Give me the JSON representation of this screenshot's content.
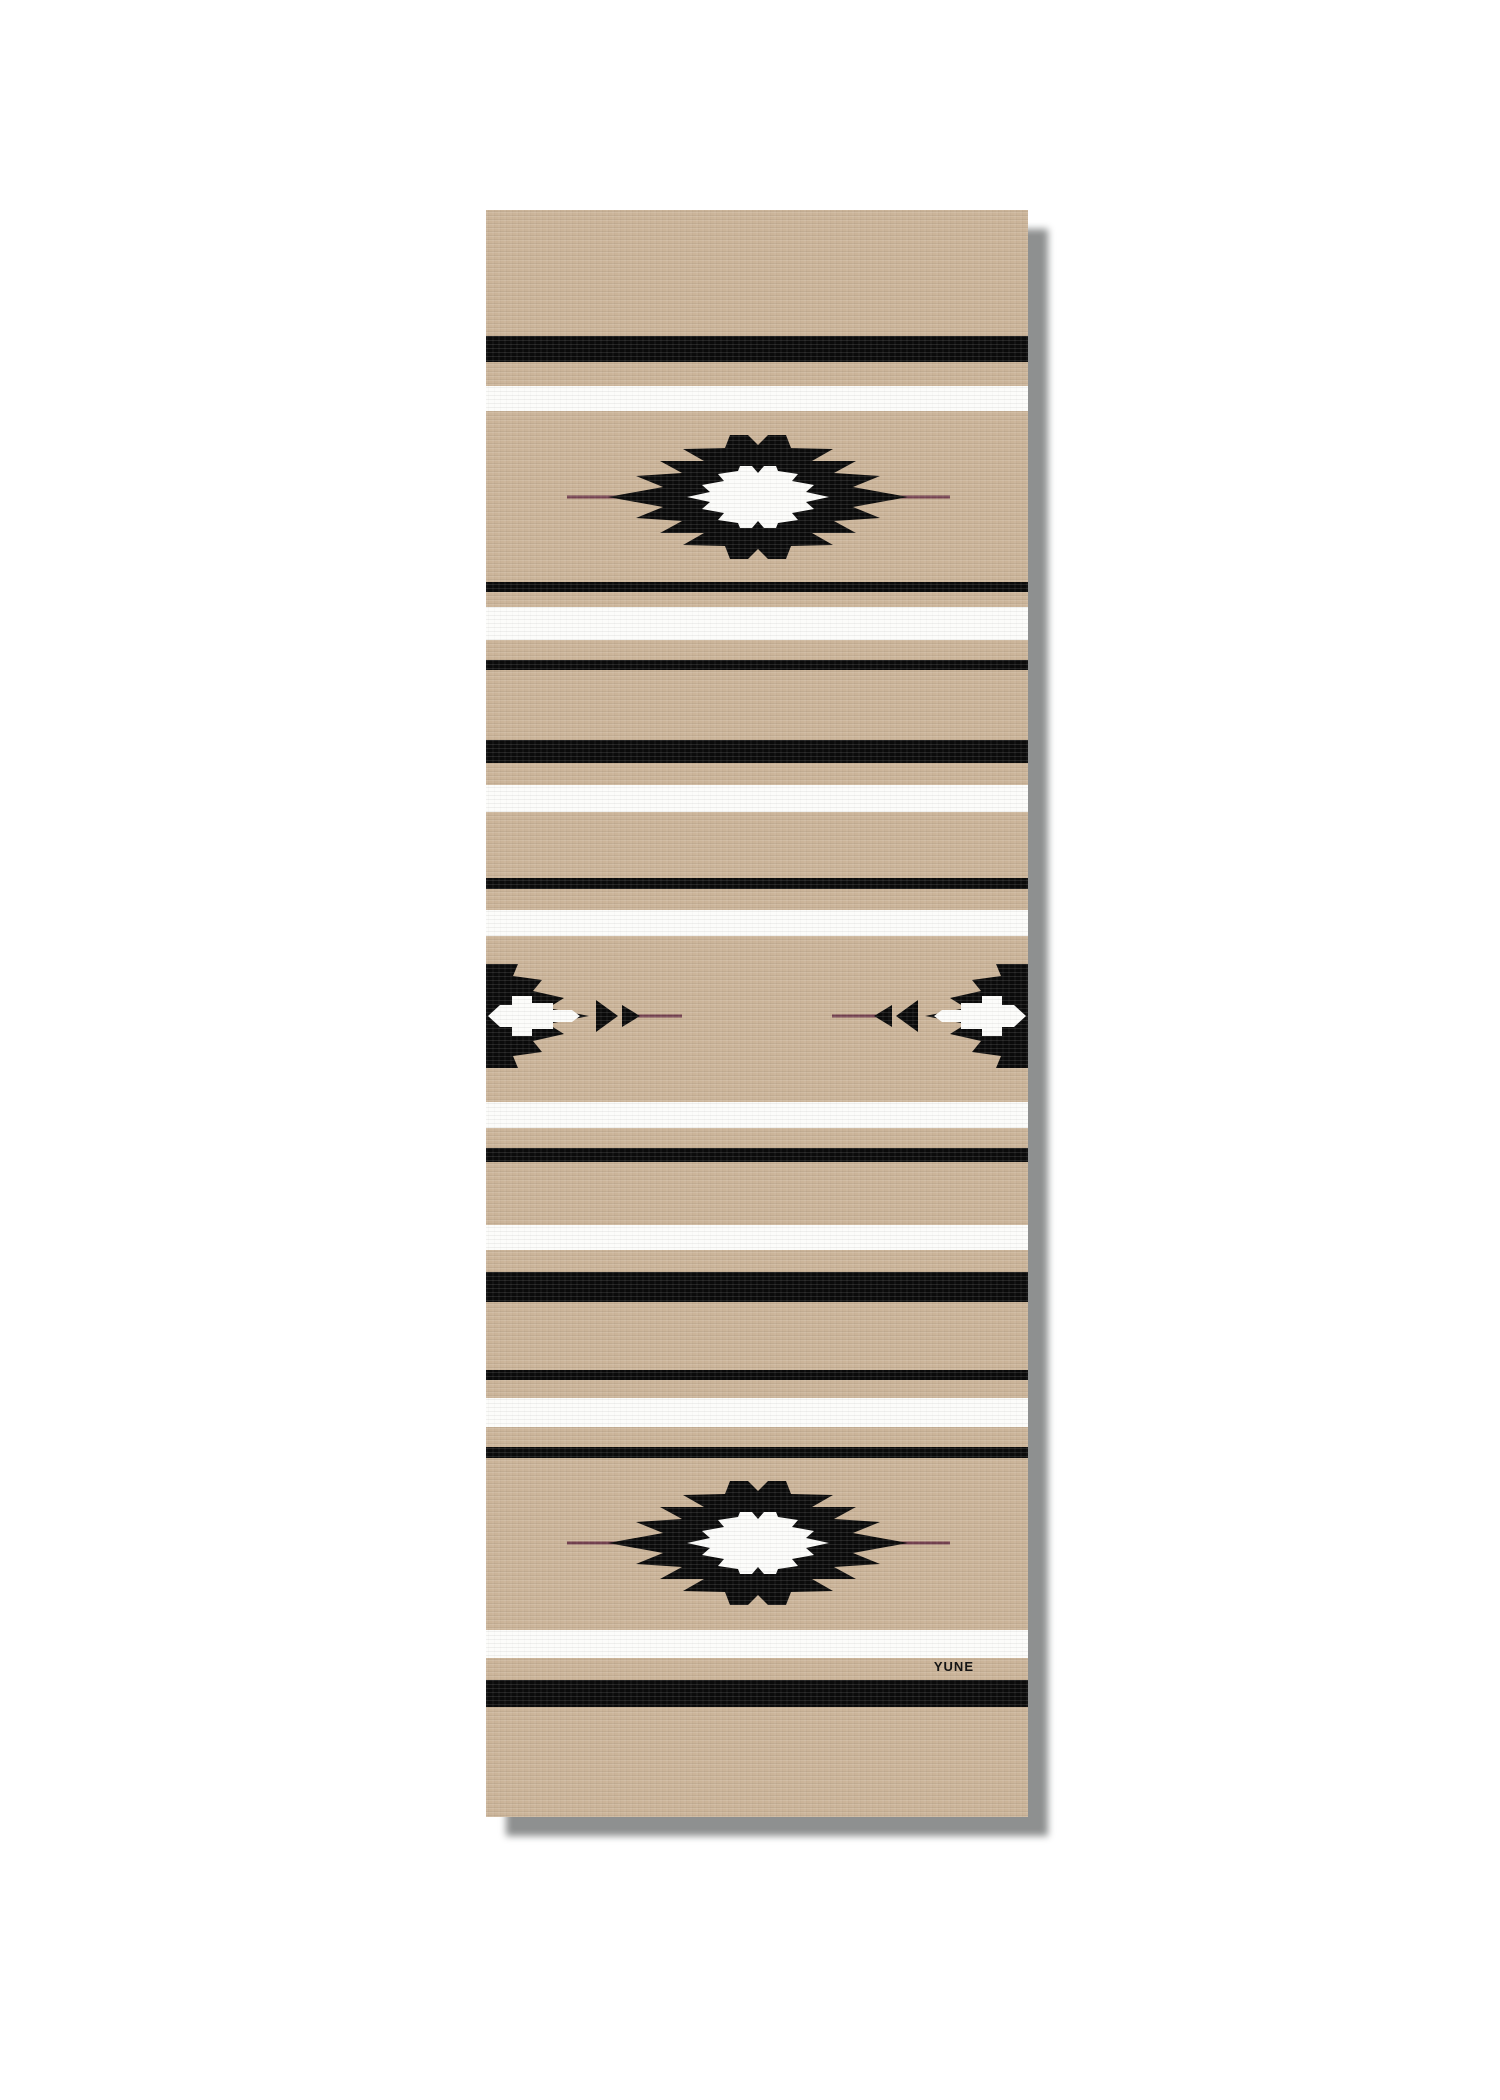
{
  "brand": {
    "logo_text": "YUNE"
  },
  "mat": {
    "x": 486,
    "y": 210,
    "width": 542,
    "height": 1607,
    "colors": {
      "tan": "#cbb499",
      "black": "#0b0b0b",
      "white": "#fcfcfa",
      "accent_line": "#744150",
      "shadow": "#8e9090",
      "logo_text": "#141414"
    },
    "shadow_offset_x": 20,
    "shadow_offset_y": 19,
    "shadow_blur": 7,
    "stripes": [
      {
        "y": 126,
        "h": 26,
        "color": "black"
      },
      {
        "y": 176,
        "h": 25,
        "color": "white"
      },
      {
        "y": 372,
        "h": 10,
        "color": "black"
      },
      {
        "y": 397,
        "h": 33,
        "color": "white"
      },
      {
        "y": 450,
        "h": 10,
        "color": "black"
      },
      {
        "y": 530,
        "h": 23,
        "color": "black"
      },
      {
        "y": 575,
        "h": 27,
        "color": "white"
      },
      {
        "y": 668,
        "h": 11,
        "color": "black"
      },
      {
        "y": 700,
        "h": 26,
        "color": "white"
      },
      {
        "y": 892,
        "h": 26,
        "color": "white"
      },
      {
        "y": 938,
        "h": 14,
        "color": "black"
      },
      {
        "y": 1015,
        "h": 25,
        "color": "white"
      },
      {
        "y": 1062,
        "h": 30,
        "color": "black"
      },
      {
        "y": 1160,
        "h": 10,
        "color": "black"
      },
      {
        "y": 1188,
        "h": 29,
        "color": "white"
      },
      {
        "y": 1237,
        "h": 11,
        "color": "black"
      },
      {
        "y": 1420,
        "h": 28,
        "color": "white"
      },
      {
        "y": 1470,
        "h": 27,
        "color": "black"
      }
    ],
    "motifs": [
      {
        "type": "full",
        "cx": 272,
        "cy": 287
      },
      {
        "type": "half",
        "side": "left",
        "cy": 806
      },
      {
        "type": "half",
        "side": "right",
        "cy": 806
      },
      {
        "type": "full",
        "cx": 272,
        "cy": 1333
      }
    ],
    "motif_geometry": {
      "full_black_quad": [
        [
          -150,
          0
        ],
        [
          -95,
          -10
        ],
        [
          -122,
          -21
        ],
        [
          -76,
          -24
        ],
        [
          -98,
          -36
        ],
        [
          -54,
          -36
        ],
        [
          -75,
          -48
        ],
        [
          -33,
          -49
        ],
        [
          -28,
          -62
        ],
        [
          -10,
          -62
        ],
        [
          0,
          -52
        ]
      ],
      "full_white_quad": [
        [
          -71,
          0
        ],
        [
          -48,
          -5
        ],
        [
          -56,
          -12
        ],
        [
          -34,
          -16
        ],
        [
          -40,
          -23
        ],
        [
          -20,
          -26
        ],
        [
          -18,
          -31
        ],
        [
          -6,
          -31
        ],
        [
          0,
          -24
        ]
      ],
      "full_line": [
        -191,
        192
      ],
      "half_black_top": [
        [
          0,
          -52
        ],
        [
          32,
          -52
        ],
        [
          27,
          -40
        ],
        [
          56,
          -36
        ],
        [
          47,
          -25
        ],
        [
          78,
          -18
        ],
        [
          62,
          -8
        ],
        [
          103,
          0
        ]
      ],
      "half_white_top": [
        [
          2,
          0
        ],
        [
          14,
          -11
        ],
        [
          26,
          -11
        ],
        [
          26,
          -20
        ],
        [
          46,
          -20
        ],
        [
          46,
          -13
        ],
        [
          67,
          -13
        ],
        [
          67,
          -6
        ],
        [
          86,
          -6
        ],
        [
          94,
          0
        ]
      ],
      "half_spikes": [
        [
          [
            110,
            -16
          ],
          [
            132,
            0
          ],
          [
            110,
            16
          ]
        ],
        [
          [
            136,
            -11
          ],
          [
            154,
            0
          ],
          [
            136,
            11
          ]
        ]
      ],
      "half_line": [
        152,
        196
      ],
      "line_width": 3
    },
    "logo": {
      "right_offset": 54,
      "top": 1450,
      "font_size": 13
    }
  }
}
